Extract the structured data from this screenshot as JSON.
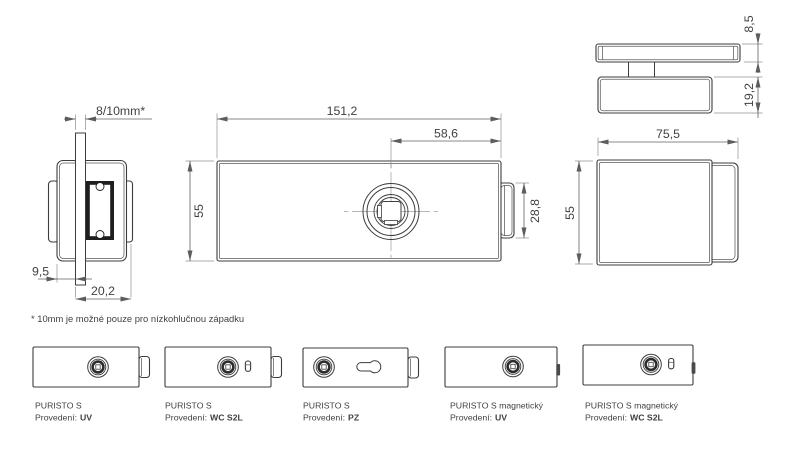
{
  "colors": {
    "line": "#3c3c3c",
    "dimension_line": "#606060",
    "text": "#414141",
    "background": "#ffffff"
  },
  "dimensions": {
    "glass_thickness": "8/10mm*",
    "front_width": "151,2",
    "spindle_to_edge": "58,6",
    "front_height": "55",
    "latch_height": "28,8",
    "clamp_offset": "9,5",
    "side_depth": "20,2",
    "cover_thickness": "8,5",
    "body_thickness": "19,2",
    "top_width": "75,5",
    "top_height": "55"
  },
  "footnote": "* 10mm je možné pouze pro nízkohlučnou západku",
  "variants": [
    {
      "name": "PURISTO S",
      "finish_label": "Provedení:",
      "finish_value": "UV"
    },
    {
      "name": "PURISTO S",
      "finish_label": "Provedení:",
      "finish_value": "WC S2L"
    },
    {
      "name": "PURISTO S",
      "finish_label": "Provedení:",
      "finish_value": "PZ"
    },
    {
      "name": "PURISTO S magnetický",
      "finish_label": "Provedení:",
      "finish_value": "UV"
    },
    {
      "name": "PURISTO S magnetický",
      "finish_label": "Provedení:",
      "finish_value": "WC S2L"
    }
  ]
}
